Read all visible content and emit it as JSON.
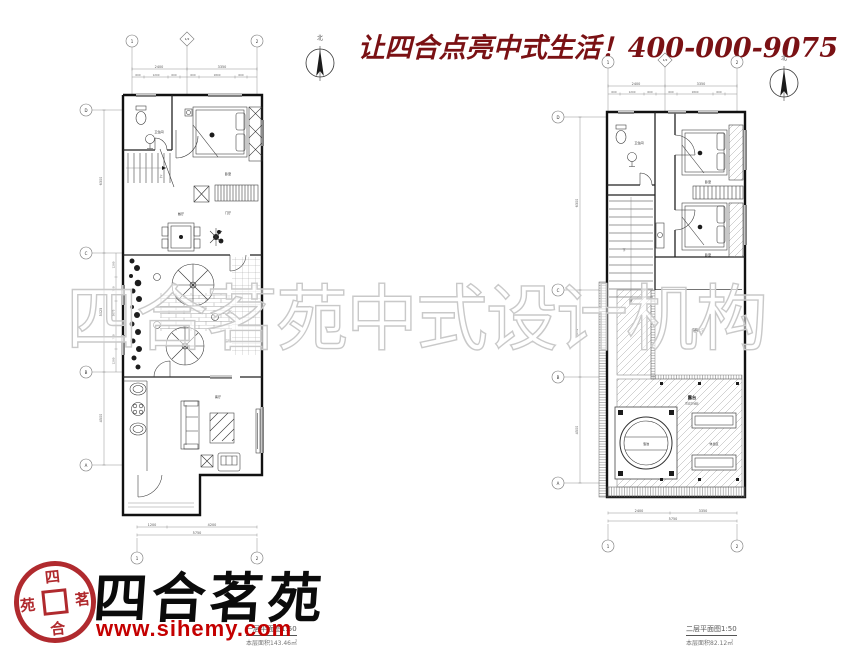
{
  "header": {
    "slogan": "让四合点亮中式生活！400-000-9075",
    "slogan_color": "#7a1114"
  },
  "watermark": {
    "text": "四合茗苑中式设计机构"
  },
  "compass": {
    "north": "北"
  },
  "logo": {
    "brand": "四合茗苑",
    "url": "www.sihemy.com",
    "red": "#b02a2e",
    "seal": {
      "top": "四",
      "right": "茗",
      "bottom": "合",
      "left": "苑"
    }
  },
  "plan_left": {
    "caption": {
      "title": "一层平面图1:50",
      "area": "本层面积143.46㎡"
    },
    "axes_cols": [
      "1",
      "1/2",
      "2"
    ],
    "axes_rows": [
      "D",
      "C",
      "B",
      "A"
    ],
    "rooms": {
      "bath": "卫生间",
      "bed": "卧室",
      "dining": "餐厅",
      "foyer": "门厅",
      "court": "庭院",
      "living": "客厅",
      "stairs_up": "上"
    },
    "dims": {
      "top": [
        "2400",
        "3350"
      ],
      "top_sub": [
        "600",
        "1200",
        "600",
        "600",
        "1800",
        "600"
      ],
      "bottom": [
        "1200",
        "4200"
      ],
      "bottom_total": "5750",
      "left": [
        "6300",
        "5025",
        "4500"
      ],
      "left_sub": [
        "1200",
        "750",
        "3075",
        "750",
        "1200"
      ]
    }
  },
  "plan_right": {
    "caption": {
      "title": "二层平面图1:50",
      "area": "本层面积82.12㎡"
    },
    "axes_cols": [
      "1",
      "1/2",
      "2"
    ],
    "axes_rows": [
      "D",
      "C",
      "B",
      "A"
    ],
    "rooms": {
      "bath": "卫生间",
      "bed1": "卧室",
      "bed2": "卧室",
      "void": "庭院上空",
      "terrace": "露台",
      "terrace_note": "防腐木铺装",
      "pool": "泡池",
      "rest": "休息区",
      "stairs_down": "下"
    },
    "dims": {
      "top": [
        "2400",
        "3350"
      ],
      "top_sub": [
        "600",
        "1200",
        "600",
        "600",
        "1800",
        "600"
      ],
      "bottom": [
        "2400",
        "3350"
      ],
      "bottom_total": "5750",
      "left": [
        "6300",
        "3075",
        "4500"
      ]
    }
  }
}
